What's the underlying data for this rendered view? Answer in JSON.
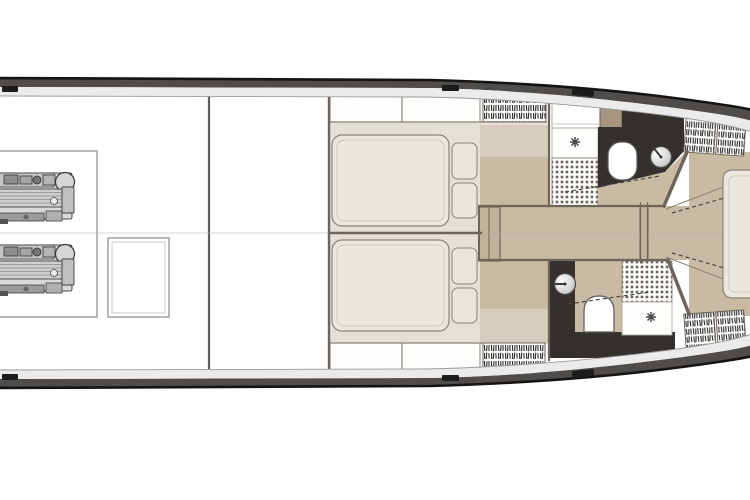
{
  "meta": {
    "title": "Yacht lower-deck floor plan",
    "view": "top-down",
    "bow_direction": "right"
  },
  "colors": {
    "background": "#ffffff",
    "hull_outline": "#141414",
    "hull_band_dark": "#4f4c4a",
    "hull_band_light": "#ebebeb",
    "hull_inner_line": "#9a9a9a",
    "wall": "#6e6459",
    "thin_line": "#8a8174",
    "centerline": "#b9b2a6",
    "cabin_floor": "#e4dfd7",
    "floor_tan": "#c9bba3",
    "floor_tan_light": "#d7cdbe",
    "floor_tan_dark": "#c2b299",
    "bath_floor_dark": "#34302c",
    "mattress": "#ebe7de",
    "mattress_edge": "#8a8276",
    "mattress_quilt": "#cfc9bf",
    "pillow": "#eae6dd",
    "cabinet_white": "#fdfdfc",
    "cabinet_tan": "#a5947e",
    "tile_dot": "#6b6257",
    "hatch_stroke": "#2b2b2b",
    "engine_body": "#d9d9d9",
    "engine_detail": "#3f3f3f",
    "fixture_white": "#ffffff",
    "fixture_stroke": "#5a5a5a",
    "drain": "#4a4a4a",
    "dash": "#4a4540",
    "cleat": "#1c1c1c"
  },
  "rooms": {
    "engine_room_label": "Engine room",
    "salon_label": "Open area",
    "cabin_port_label": "Port guest cabin",
    "cabin_starboard_label": "Starboard guest cabin",
    "head_port_label": "Port bathroom",
    "head_starboard_label": "Starboard bathroom",
    "corridor_label": "Corridor with steps",
    "bow_cabin_label": "Forward cabin"
  },
  "fixtures": {
    "engine_label": "Engine",
    "engine_hatch_label": "Engine room hatch",
    "double_bed_label": "Double bed",
    "pillow_label": "Pillow",
    "bow_bed_label": "Forward berth",
    "toilet_label": "Toilet",
    "sink_label": "Washbasin",
    "shower_tile_label": "Shower mosaic floor",
    "shower_drain_label": "Shower drain",
    "wardrobe_label": "Hanging locker",
    "cabinet_label": "Cabinet",
    "vanity_label": "Vanity unit",
    "cleat_label": "Mooring cleat",
    "step_label": "Companionway steps",
    "door_frame_label": "Door frame",
    "hull_label": "Hull and side deck"
  }
}
